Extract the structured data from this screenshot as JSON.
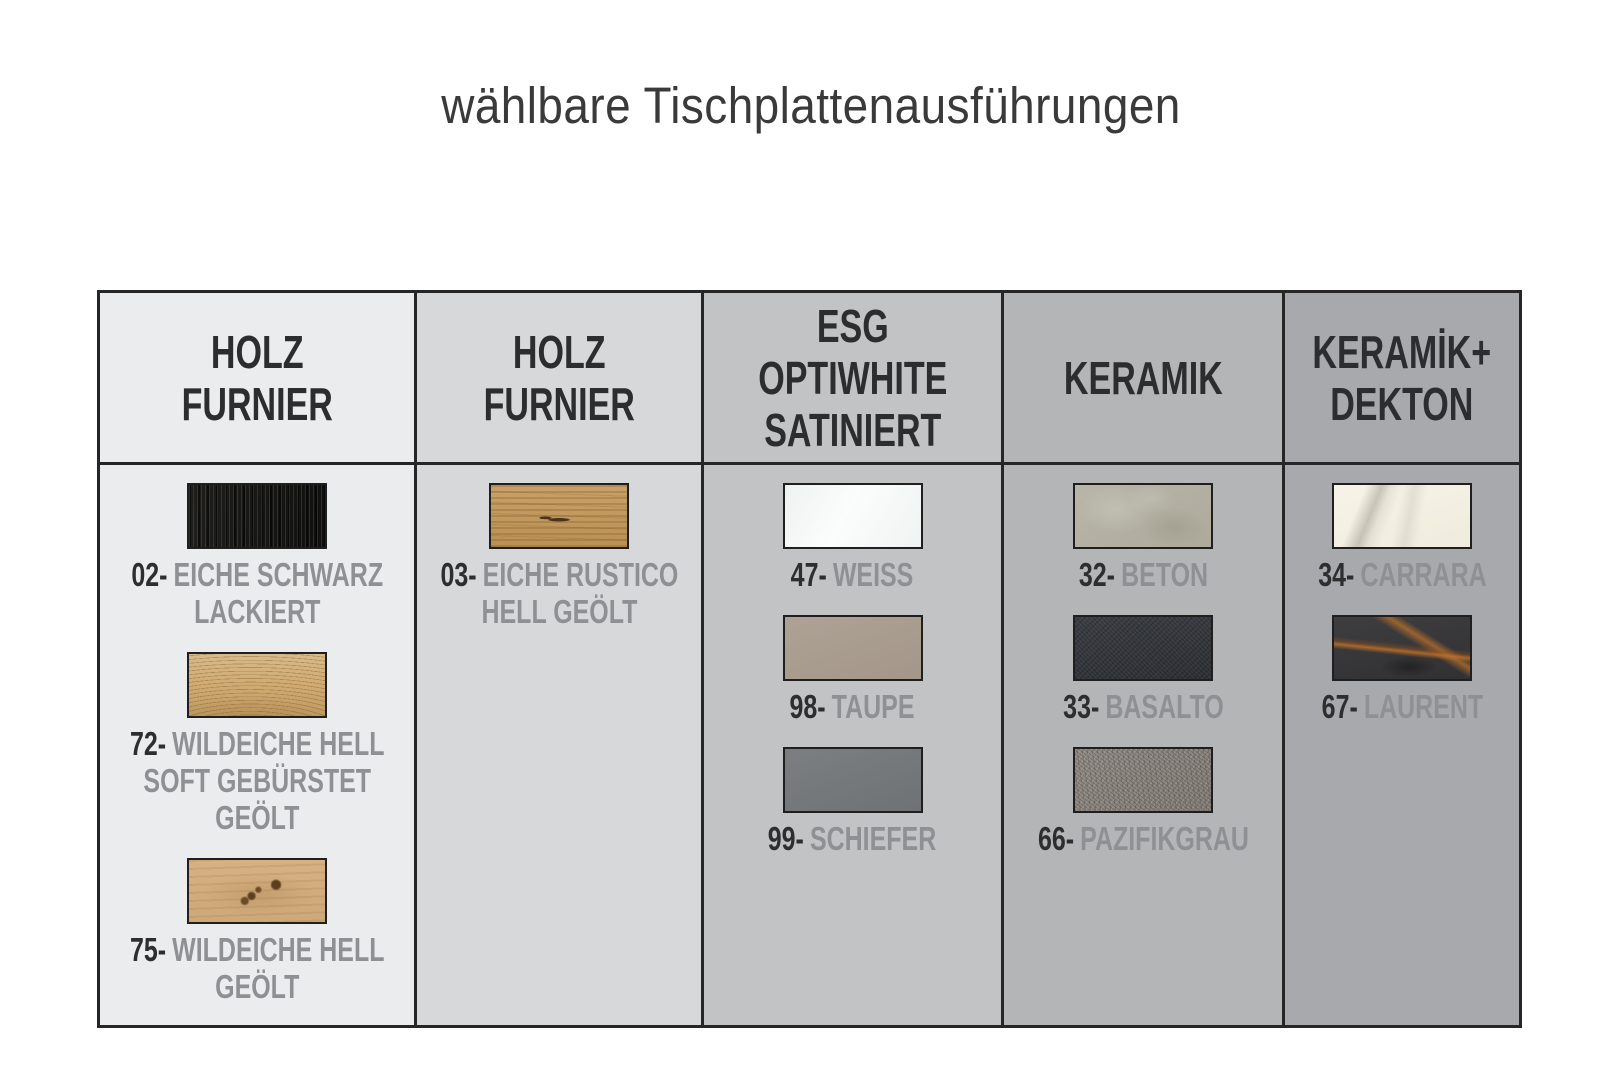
{
  "page": {
    "title": "wählbare Tischplattenausführungen"
  },
  "palette": {
    "border": "#262626",
    "header_text": "#2b2d2e",
    "code_text": "#2e2e2e",
    "name_text": "#8e9093",
    "page_background": "#ffffff"
  },
  "table": {
    "columns": [
      {
        "header": "HOLZ\nFURNIER",
        "bg": "#ebeced",
        "items": [
          {
            "code": "02-",
            "name": "EICHE SCHWARZ LACKIERT",
            "swatch": "eiche-schwarz-lackiert",
            "color": "#161614"
          },
          {
            "code": "72-",
            "name": "WILDEICHE HELL SOFT GEBÜRSTET GEÖLT",
            "swatch": "wildeiche-hell-soft-gebuerstet-geoelt",
            "color": "#cfa970"
          },
          {
            "code": "75-",
            "name": "WILDEICHE HELL GEÖLT",
            "swatch": "wildeiche-hell-geoelt",
            "color": "#d2ac7c"
          }
        ]
      },
      {
        "header": "HOLZ\nFURNIER",
        "bg": "#d7d8d9",
        "items": [
          {
            "code": "03-",
            "name": "EICHE RUSTICO HELL GEÖLT",
            "swatch": "eiche-rustico-hell-geoelt",
            "color": "#c29a60"
          }
        ]
      },
      {
        "header": "ESG\nOPTIWHITE\nSATINIERT",
        "bg": "#c1c3c5",
        "items": [
          {
            "code": "47-",
            "name": "WEISS",
            "swatch": "weiss",
            "color": "#f4f7f6"
          },
          {
            "code": "98-",
            "name": "TAUPE",
            "swatch": "taupe",
            "color": "#a89c8f"
          },
          {
            "code": "99-",
            "name": "SCHIEFER",
            "swatch": "schiefer",
            "color": "#74787b"
          }
        ]
      },
      {
        "header": "KERAMIK",
        "bg": "#b3b5b7",
        "items": [
          {
            "code": "32-",
            "name": "BETON",
            "swatch": "beton",
            "color": "#b3b0a3"
          },
          {
            "code": "33-",
            "name": "BASALTO",
            "swatch": "basalto",
            "color": "#33363c"
          },
          {
            "code": "66-",
            "name": "PAZIFIKGRAU",
            "swatch": "pazifikgrau",
            "color": "#89837e"
          }
        ]
      },
      {
        "header": "KERAMİK+\nDEKTON",
        "bg": "#a7a9ac",
        "items": [
          {
            "code": "34-",
            "name": "CARRARA",
            "swatch": "carrara",
            "color": "#f3efe2"
          },
          {
            "code": "67-",
            "name": "LAURENT",
            "swatch": "laurent",
            "color": "#3a3a3c"
          }
        ]
      }
    ]
  }
}
